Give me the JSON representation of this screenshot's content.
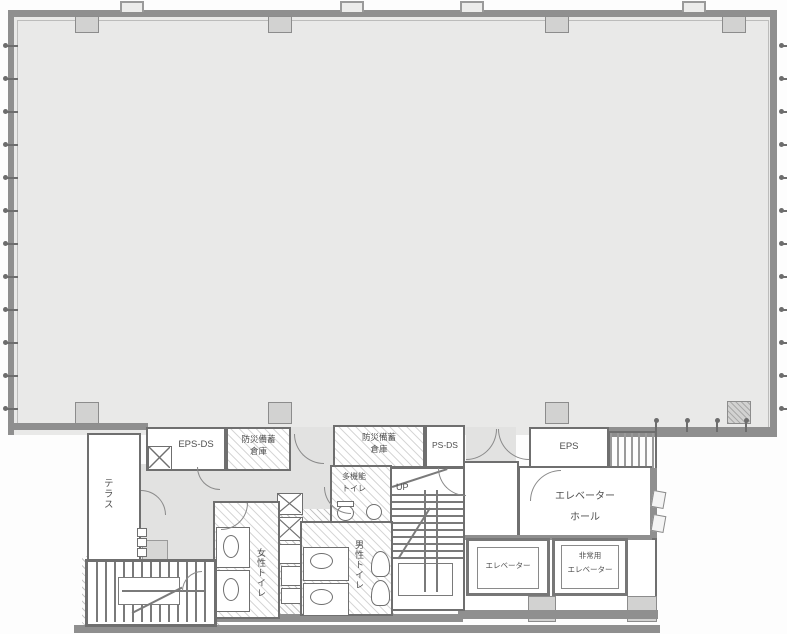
{
  "labels": {
    "terrace": "テラス",
    "eps_ds": "EPS-DS",
    "storage": {
      "line1": "防災備蓄",
      "line2": "倉庫"
    },
    "ps_ds": "PS-DS",
    "eps": "EPS",
    "multi_toilet": {
      "line1": "多機能",
      "line2": "トイレ"
    },
    "womens_toilet": "女性トイレ",
    "mens_toilet": "男性トイレ",
    "up": "UP",
    "elevator_hall": {
      "line1": "エレベーター",
      "line2": "ホール"
    },
    "elevator": "エレベーター",
    "emergency_elevator": {
      "line1": "非常用",
      "line2": "エレベーター"
    }
  },
  "colors": {
    "office_fill": "#e9e9e8",
    "corridor_fill": "#e2e2e1",
    "wall": "#8f8f8f",
    "line": "#6f6f6f",
    "text": "#4f4f4f",
    "column_fill": "#d2d2d1",
    "ground": "#8f8f8f"
  }
}
